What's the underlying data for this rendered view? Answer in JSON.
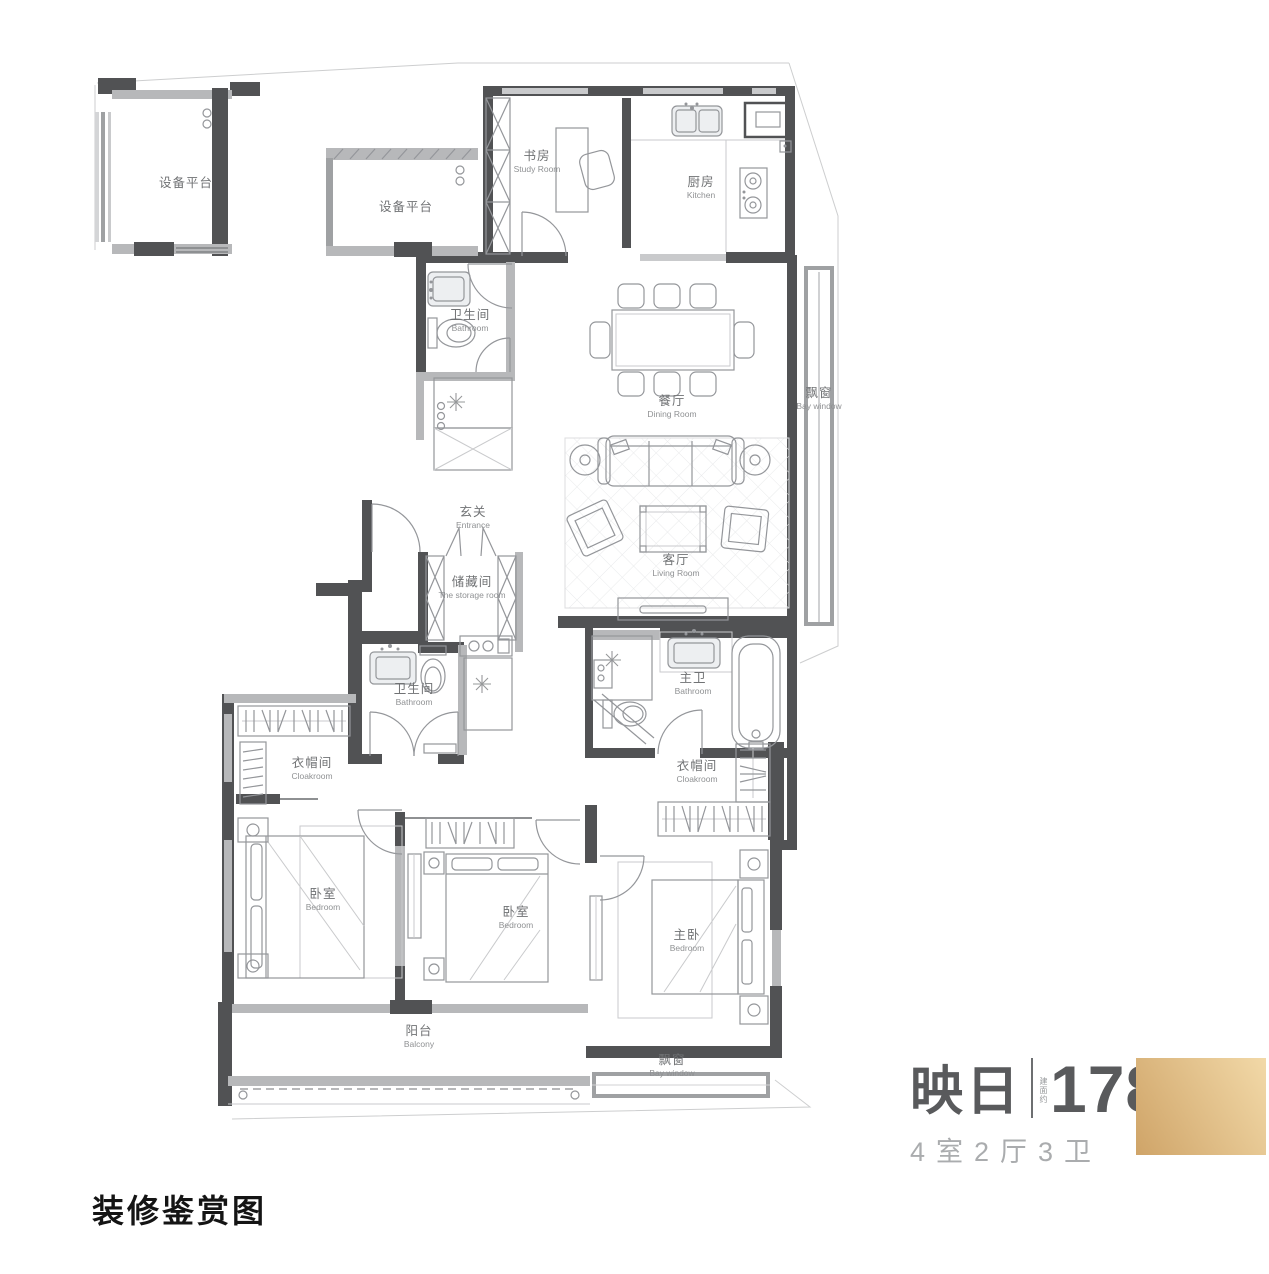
{
  "page": {
    "background": "#ffffff"
  },
  "plan": {
    "rooms": [
      {
        "id": "equipment-platform-1",
        "zh": "设备平台",
        "en": ""
      },
      {
        "id": "equipment-platform-2",
        "zh": "设备平台",
        "en": ""
      },
      {
        "id": "study",
        "zh": "书房",
        "en": "Study Room"
      },
      {
        "id": "kitchen",
        "zh": "厨房",
        "en": "Kitchen"
      },
      {
        "id": "bathroom-upper",
        "zh": "卫生间",
        "en": "Bathroom"
      },
      {
        "id": "dining-room",
        "zh": "餐厅",
        "en": "Dining Room"
      },
      {
        "id": "bay-window-right",
        "zh": "飘窗",
        "en": "Bay window"
      },
      {
        "id": "entrance",
        "zh": "玄关",
        "en": "Entrance"
      },
      {
        "id": "storage-room",
        "zh": "储藏间",
        "en": "The storage room"
      },
      {
        "id": "living-room",
        "zh": "客厅",
        "en": "Living Room"
      },
      {
        "id": "bathroom-lower",
        "zh": "卫生间",
        "en": "Bathroom"
      },
      {
        "id": "master-bathroom",
        "zh": "主卫",
        "en": "Bathroom"
      },
      {
        "id": "cloakroom-left",
        "zh": "衣帽间",
        "en": "Cloakroom"
      },
      {
        "id": "cloakroom-right",
        "zh": "衣帽间",
        "en": "Cloakroom"
      },
      {
        "id": "bedroom-left",
        "zh": "卧室",
        "en": "Bedroom"
      },
      {
        "id": "bedroom-middle",
        "zh": "卧室",
        "en": "Bedroom"
      },
      {
        "id": "master-bedroom",
        "zh": "主卧",
        "en": "Bedroom"
      },
      {
        "id": "balcony",
        "zh": "阳台",
        "en": "Balcony"
      },
      {
        "id": "bay-window-bottom",
        "zh": "飘窗",
        "en": "Bay window"
      }
    ]
  },
  "legend": {
    "unit_name": "映日",
    "area_prefix": "建面约",
    "area_value": "178",
    "area_unit_base": "m",
    "area_unit_sup": "2",
    "layout_spec": "4室2厅3卫",
    "text_color": "#595a5c",
    "sub_text_color": "#aaacae",
    "swatch_color_start": "#cfa468",
    "swatch_color_end": "#f2d9a8"
  },
  "footer": {
    "caption": "装修鉴赏图"
  }
}
